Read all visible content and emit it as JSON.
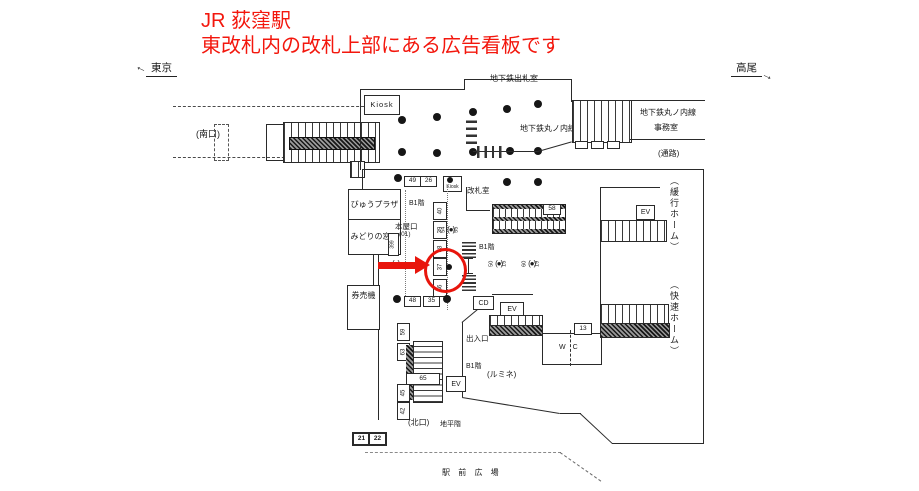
{
  "title": {
    "line1": "JR 荻窪駅",
    "line2": "東改札内の改札上部にある広告看板です"
  },
  "directions": {
    "left": "東京",
    "right": "高尾"
  },
  "labels": {
    "south_exit": "(南口)",
    "subway_ticket_office": "地下鉄出札室",
    "kiosk_large": "Kiosk",
    "kiosk_small": "Kiosk",
    "marunouchi_line_center": "地下鉄丸ノ内線",
    "marunouchi_line_right": "地下鉄丸ノ内線",
    "office": "事務室",
    "passage": "(通路)",
    "view_plaza": "びゅうプラザ",
    "midori_window": "みどりの窓口",
    "ticket_machines": "券売機",
    "gate_room": "改札室",
    "b1_upper": "B1階",
    "b1_mid": "B1階",
    "b1_lower": "B1階",
    "main_entrance": "本屋口",
    "main_entrance_no": "(01)",
    "entrance": "出入口",
    "lumine": "(ルミネ)",
    "north_exit": "(北口)",
    "ground_level": "地平階",
    "station_square": "駅 前 広 場",
    "wc": "WC",
    "cd": "CD",
    "ev": "EV",
    "local_platform": "（緩行ホーム）",
    "rapid_platform": "（快速ホーム）"
  },
  "number_boxes": {
    "b49": "49",
    "b26": "26",
    "b58": "58",
    "b48": "48",
    "b35": "35",
    "b13": "13",
    "b59": "59",
    "b63": "63",
    "b65": "65",
    "b45": "45",
    "b42": "42",
    "b21": "21",
    "b22": "22",
    "b399": "399"
  },
  "sign_column": [
    "40",
    "39",
    "38",
    "37",
    "36"
  ],
  "signs": [
    {
      "left": "54",
      "right": "55"
    },
    {
      "left": "50",
      "right": "15"
    },
    {
      "left": "60",
      "right": "19"
    }
  ],
  "annotation": {
    "highlighted_position": "37",
    "title_color": "#f3170d",
    "marker_color": "#e8150c",
    "line_color": "#2a2a2a"
  }
}
